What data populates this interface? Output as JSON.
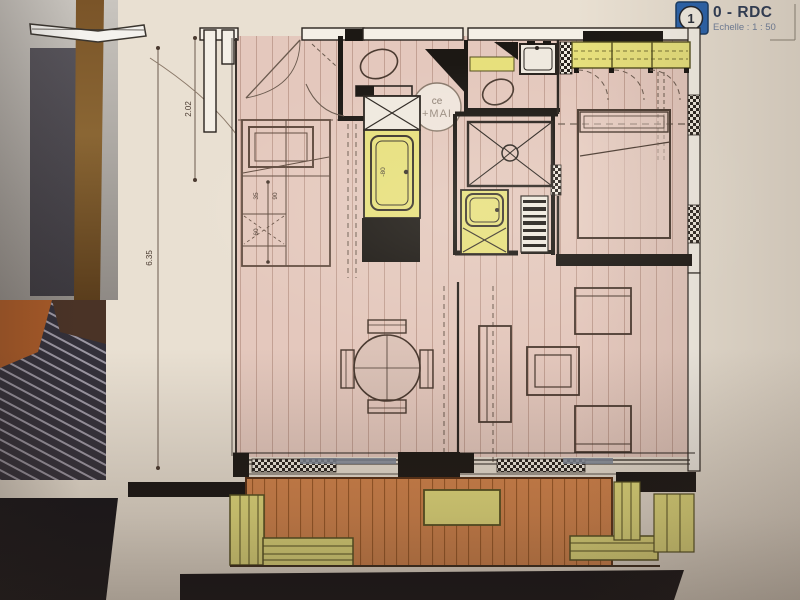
{
  "sheet": {
    "badge_number": "1",
    "title": "0 - RDC",
    "scale_label": "Echelle : 1 : 50"
  },
  "plan": {
    "column_label_line1": "ce",
    "column_label_line2": "+MAI",
    "appliance_label": "-80",
    "dim_left_total": "6.35",
    "dim_left_upper": "2.02",
    "dim_kitchen_1": "35",
    "dim_kitchen_2": "90",
    "dim_kitchen_3": "60"
  }
}
